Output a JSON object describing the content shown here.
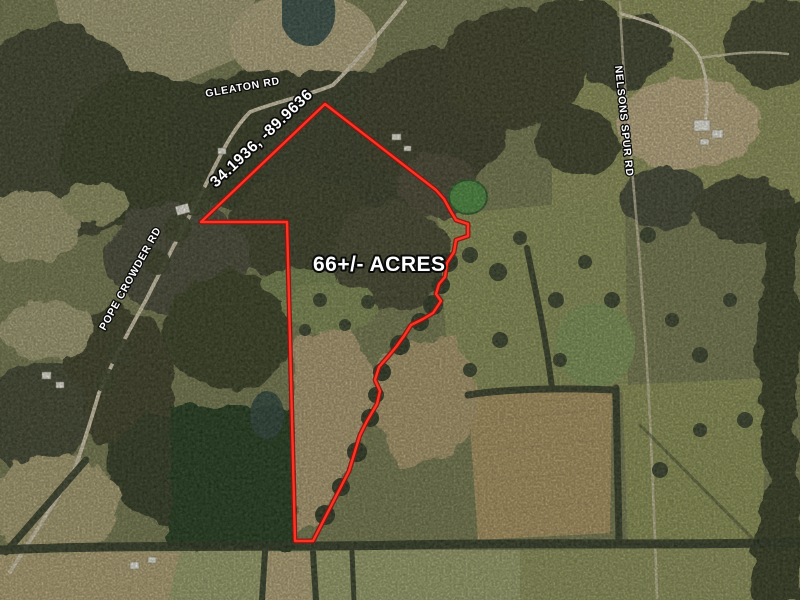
{
  "map": {
    "acreage_label": "66+/- ACRES",
    "coordinates_label": "34.1936, -89.9636",
    "roads": {
      "gleaton": "GLEATON RD",
      "pope_crowder": "POPE CROWDER RD",
      "nelsons_spur": "NELSONS SPUR RD"
    },
    "boundary": {
      "color": "#ff3323",
      "casing_color": "#8d1410"
    },
    "label_style": {
      "text_color": "#ffffff",
      "outline_color": "#0b0b0b"
    }
  }
}
